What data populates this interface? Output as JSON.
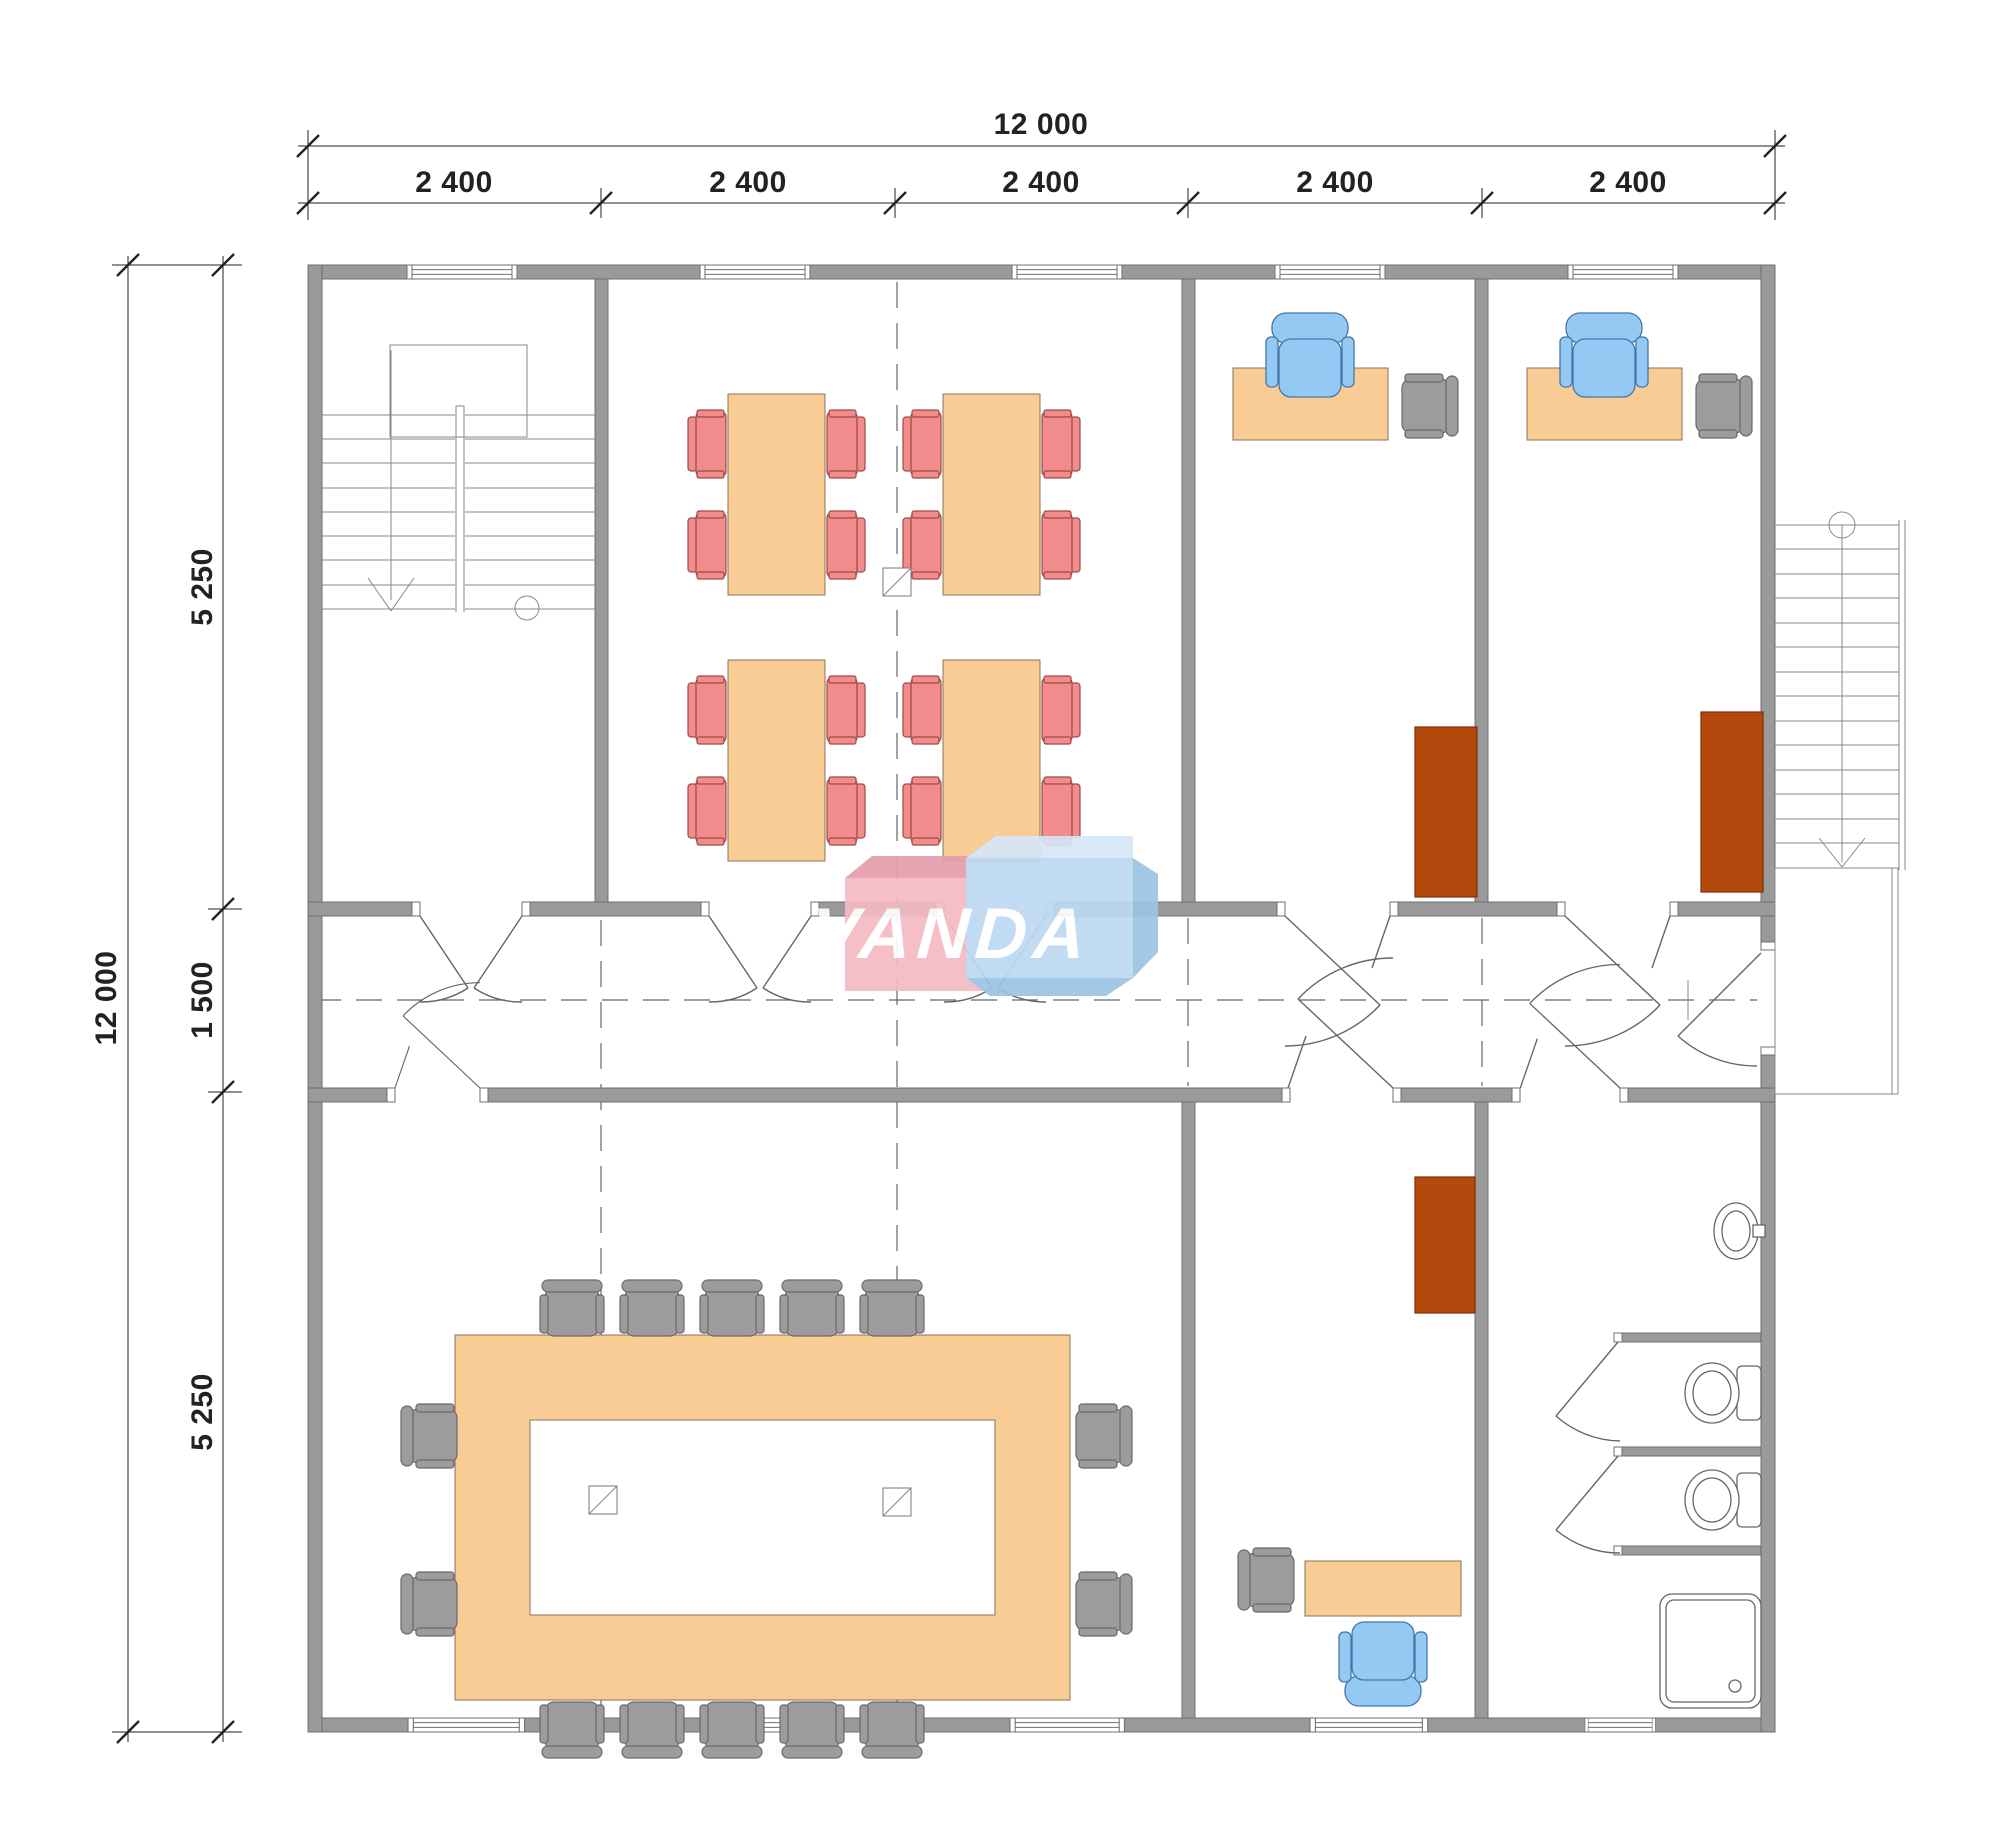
{
  "dimensions": {
    "top": {
      "total": "12 000",
      "segments": [
        "2 400",
        "2 400",
        "2 400",
        "2 400",
        "2 400"
      ]
    },
    "left": {
      "total": "12 000",
      "segments": [
        "5 250",
        "1 500",
        "5 250"
      ]
    }
  },
  "logo": {
    "text": "VANDA"
  },
  "colors": {
    "wall": "#9A9A9A",
    "wall_edge": "#6F6F6F",
    "line": "#222222",
    "thin": "#666666",
    "table": "#F9CC96",
    "table_edge": "#8A7355",
    "chair_red": "#F28C8C",
    "chair_red_edge": "#9C4A44",
    "chair_blue": "#93C9F2",
    "chair_blue_edge": "#4577A8",
    "chair_gray": "#9C9C9C",
    "chair_gray_edge": "#696969",
    "cabinet": "#B5490D",
    "cabinet_edge": "#7A3008",
    "logo_pink": "#F5BAC4",
    "logo_pink_dark": "#E39EAD",
    "logo_blue": "#BCD9F2",
    "logo_blue_light": "#D6E7F7",
    "logo_blue_dark": "#9CC4E4",
    "logo_text": "#FFFFFF"
  },
  "rooms": [
    {
      "name": "stair-hall",
      "furniture": [
        "interior-staircase"
      ]
    },
    {
      "name": "classroom",
      "furniture": [
        "table-4",
        "red-chair-16",
        "column-1"
      ]
    },
    {
      "name": "office-1",
      "furniture": [
        "desk",
        "office-chair",
        "guest-chair",
        "cabinet"
      ]
    },
    {
      "name": "office-2",
      "furniture": [
        "desk",
        "office-chair",
        "guest-chair",
        "cabinet"
      ]
    },
    {
      "name": "corridor",
      "furniture": []
    },
    {
      "name": "conference-room",
      "furniture": [
        "ring-table",
        "gray-chair-14",
        "column-2"
      ]
    },
    {
      "name": "office-3",
      "furniture": [
        "desk",
        "office-chair",
        "guest-chair",
        "cabinet"
      ]
    },
    {
      "name": "bathroom",
      "furniture": [
        "sink",
        "toilet-2",
        "shower"
      ]
    },
    {
      "name": "exterior",
      "furniture": [
        "exterior-staircase",
        "landing"
      ]
    }
  ]
}
